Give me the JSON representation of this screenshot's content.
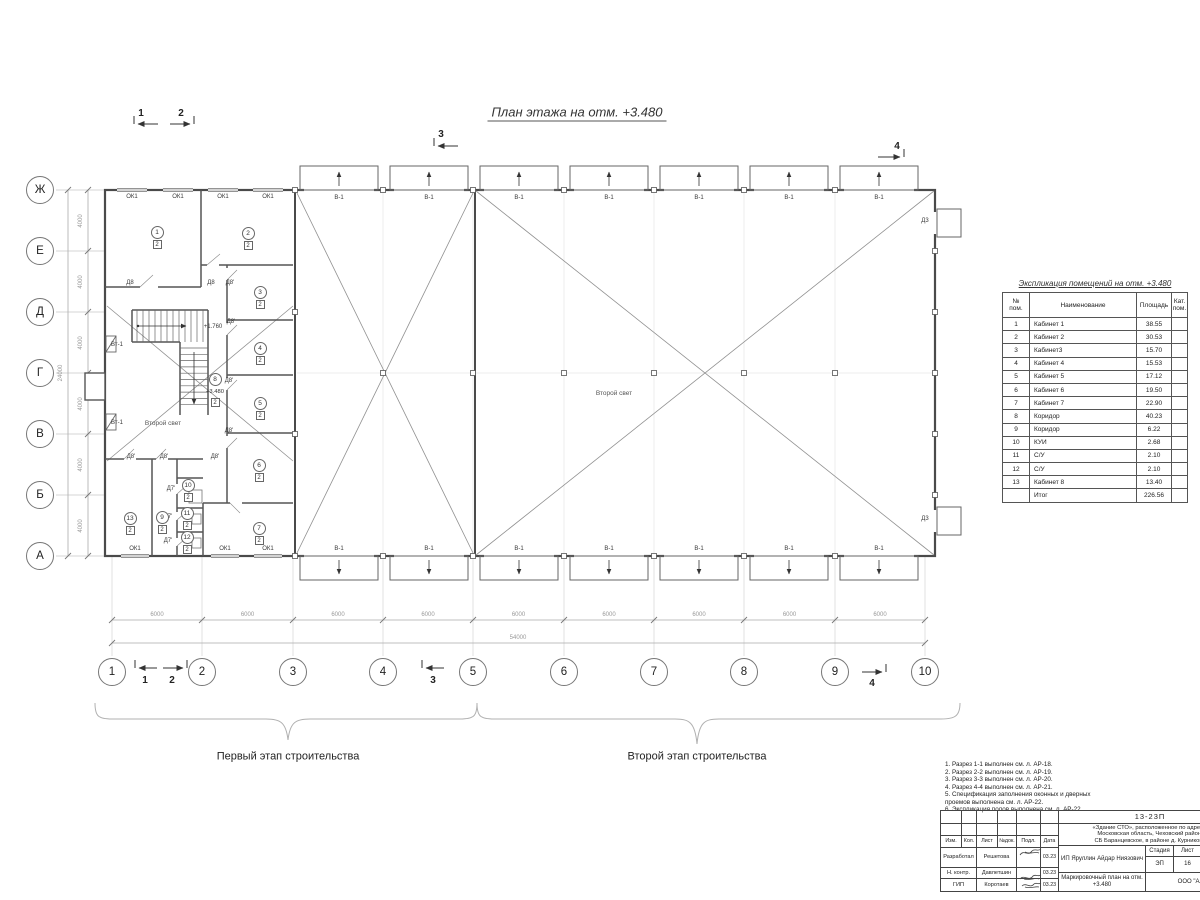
{
  "page_title": "План этажа на отм. +3.480",
  "axes": {
    "columns": [
      "1",
      "2",
      "3",
      "4",
      "5",
      "6",
      "7",
      "8",
      "9",
      "10"
    ],
    "rows": [
      "Ж",
      "Е",
      "Д",
      "Г",
      "В",
      "Б",
      "А"
    ]
  },
  "dimensions": {
    "column_spacing": "6000",
    "columns_total": "54000",
    "row_spacing": "4000",
    "rows_total": "24000"
  },
  "section_marks": [
    {
      "n": "1",
      "x": 141,
      "y": 114
    },
    {
      "n": "2",
      "x": 181,
      "y": 114
    },
    {
      "n": "3",
      "x": 441,
      "y": 135
    },
    {
      "n": "4",
      "x": 897,
      "y": 147
    },
    {
      "n": "1",
      "x": 145,
      "y": 681
    },
    {
      "n": "2",
      "x": 172,
      "y": 681
    },
    {
      "n": "3",
      "x": 433,
      "y": 681
    },
    {
      "n": "4",
      "x": 872,
      "y": 684
    }
  ],
  "gate_label": "В-1",
  "window_label": "ОК1",
  "plan_labels": [
    {
      "t": "Д8",
      "x": 130,
      "y": 283
    },
    {
      "t": "Д8",
      "x": 211,
      "y": 283
    },
    {
      "t": "Д8'",
      "x": 230,
      "y": 283
    },
    {
      "t": "Д8'",
      "x": 231,
      "y": 322
    },
    {
      "t": "Д8'",
      "x": 229,
      "y": 381
    },
    {
      "t": "Д8'",
      "x": 229,
      "y": 431
    },
    {
      "t": "Д8'",
      "x": 215,
      "y": 457
    },
    {
      "t": "Д8'",
      "x": 164,
      "y": 457
    },
    {
      "t": "Д8'",
      "x": 131,
      "y": 457
    },
    {
      "t": "Д7'",
      "x": 171,
      "y": 489
    },
    {
      "t": "Д7'",
      "x": 168,
      "y": 517
    },
    {
      "t": "Д7'",
      "x": 168,
      "y": 541
    },
    {
      "t": "Д3",
      "x": 925,
      "y": 221
    },
    {
      "t": "Д3",
      "x": 925,
      "y": 519
    },
    {
      "t": "Вт-1",
      "x": 117,
      "y": 345
    },
    {
      "t": "Вт-1",
      "x": 117,
      "y": 423
    },
    {
      "t": "+1.760",
      "x": 213,
      "y": 327
    }
  ],
  "second_light_left": "Второй свет",
  "second_light_main": "Второй свет",
  "rooms": [
    {
      "n": "1",
      "cat": "2",
      "x": 157,
      "y": 232
    },
    {
      "n": "2",
      "cat": "2",
      "x": 248,
      "y": 233
    },
    {
      "n": "3",
      "cat": "2",
      "x": 260,
      "y": 292
    },
    {
      "n": "4",
      "cat": "2",
      "x": 260,
      "y": 348
    },
    {
      "n": "5",
      "cat": "2",
      "x": 260,
      "y": 403
    },
    {
      "n": "6",
      "cat": "2",
      "x": 259,
      "y": 465
    },
    {
      "n": "7",
      "cat": "2",
      "x": 259,
      "y": 528
    },
    {
      "n": "8",
      "cat": "2",
      "x": 215,
      "y": 379,
      "mark": "+3.480"
    },
    {
      "n": "9",
      "cat": "2",
      "x": 162,
      "y": 517
    },
    {
      "n": "10",
      "cat": "2",
      "x": 188,
      "y": 485
    },
    {
      "n": "11",
      "cat": "2",
      "x": 187,
      "y": 513
    },
    {
      "n": "12",
      "cat": "2",
      "x": 187,
      "y": 537
    },
    {
      "n": "13",
      "cat": "2",
      "x": 130,
      "y": 518
    }
  ],
  "stages": {
    "first": "Первый этап строительства",
    "second": "Второй этап строительства"
  },
  "notes": {
    "items": [
      "1. Разрез 1-1 выполнен см. л. АР-18.",
      "2. Разрез 2-2 выполнен см. л. АР-19.",
      "3. Разрез 3-3 выполнен см. л. АР-20.",
      "4. Разрез 4-4 выполнен см. л. АР-21.",
      "5. Спецификация заполнения оконных и дверных",
      "    проемов выполнена см. л. АР-22.",
      "6. Экспликация полов выполнена см. л. АР-22."
    ]
  },
  "schedule": {
    "title": "Экспликация помещений на отм. +3.480",
    "headers": {
      "num": "№ пом.",
      "name": "Наименование",
      "area": "Площадь",
      "cat": "Кат. пом."
    },
    "rows": [
      [
        "1",
        "Кабинет 1",
        "38.55",
        ""
      ],
      [
        "2",
        "Кабинет 2",
        "30.53",
        ""
      ],
      [
        "3",
        "Кабинет3",
        "15.70",
        ""
      ],
      [
        "4",
        "Кабинет 4",
        "15.53",
        ""
      ],
      [
        "5",
        "Кабинет 5",
        "17.12",
        ""
      ],
      [
        "6",
        "Кабинет 6",
        "19.50",
        ""
      ],
      [
        "7",
        "Кабинет 7",
        "22.90",
        ""
      ],
      [
        "8",
        "Коридор",
        "40.23",
        ""
      ],
      [
        "9",
        "Коридор",
        "6.22",
        ""
      ],
      [
        "10",
        "КУИ",
        "2.68",
        ""
      ],
      [
        "11",
        "С/У",
        "2.10",
        ""
      ],
      [
        "12",
        "С/У",
        "2.10",
        ""
      ],
      [
        "13",
        "Кабинет 8",
        "13.40",
        ""
      ],
      [
        "",
        "Итог",
        "226.56",
        ""
      ]
    ]
  },
  "title_block": {
    "doc_number": "13-23П",
    "address_lines": [
      "«Здание СТО», расположенное по адресу:",
      "Московская область, Чеховский район,",
      "СБ Баранцевское, в районе д. Курниково"
    ],
    "columns": [
      "Изм.",
      "Кол.",
      "Лист",
      "№док.",
      "Подл.",
      "Дата"
    ],
    "people": [
      {
        "role": "Разработал",
        "name": "Решетова",
        "date": "03.23"
      },
      {
        "role": "Н. контр.",
        "name": "Давлетшин",
        "date": "03.23"
      },
      {
        "role": "ГИП",
        "name": "Коротаев",
        "date": "03.23"
      }
    ],
    "client": "ИП Яруллин Айдар Ниязович",
    "stage_label": "Стадия",
    "sheet_label": "Лист",
    "stage_value": "ЭП",
    "sheet_value": "16",
    "doc_title": "Маркировочный план на отм. +3.480",
    "company": "ООО \"Альп"
  }
}
